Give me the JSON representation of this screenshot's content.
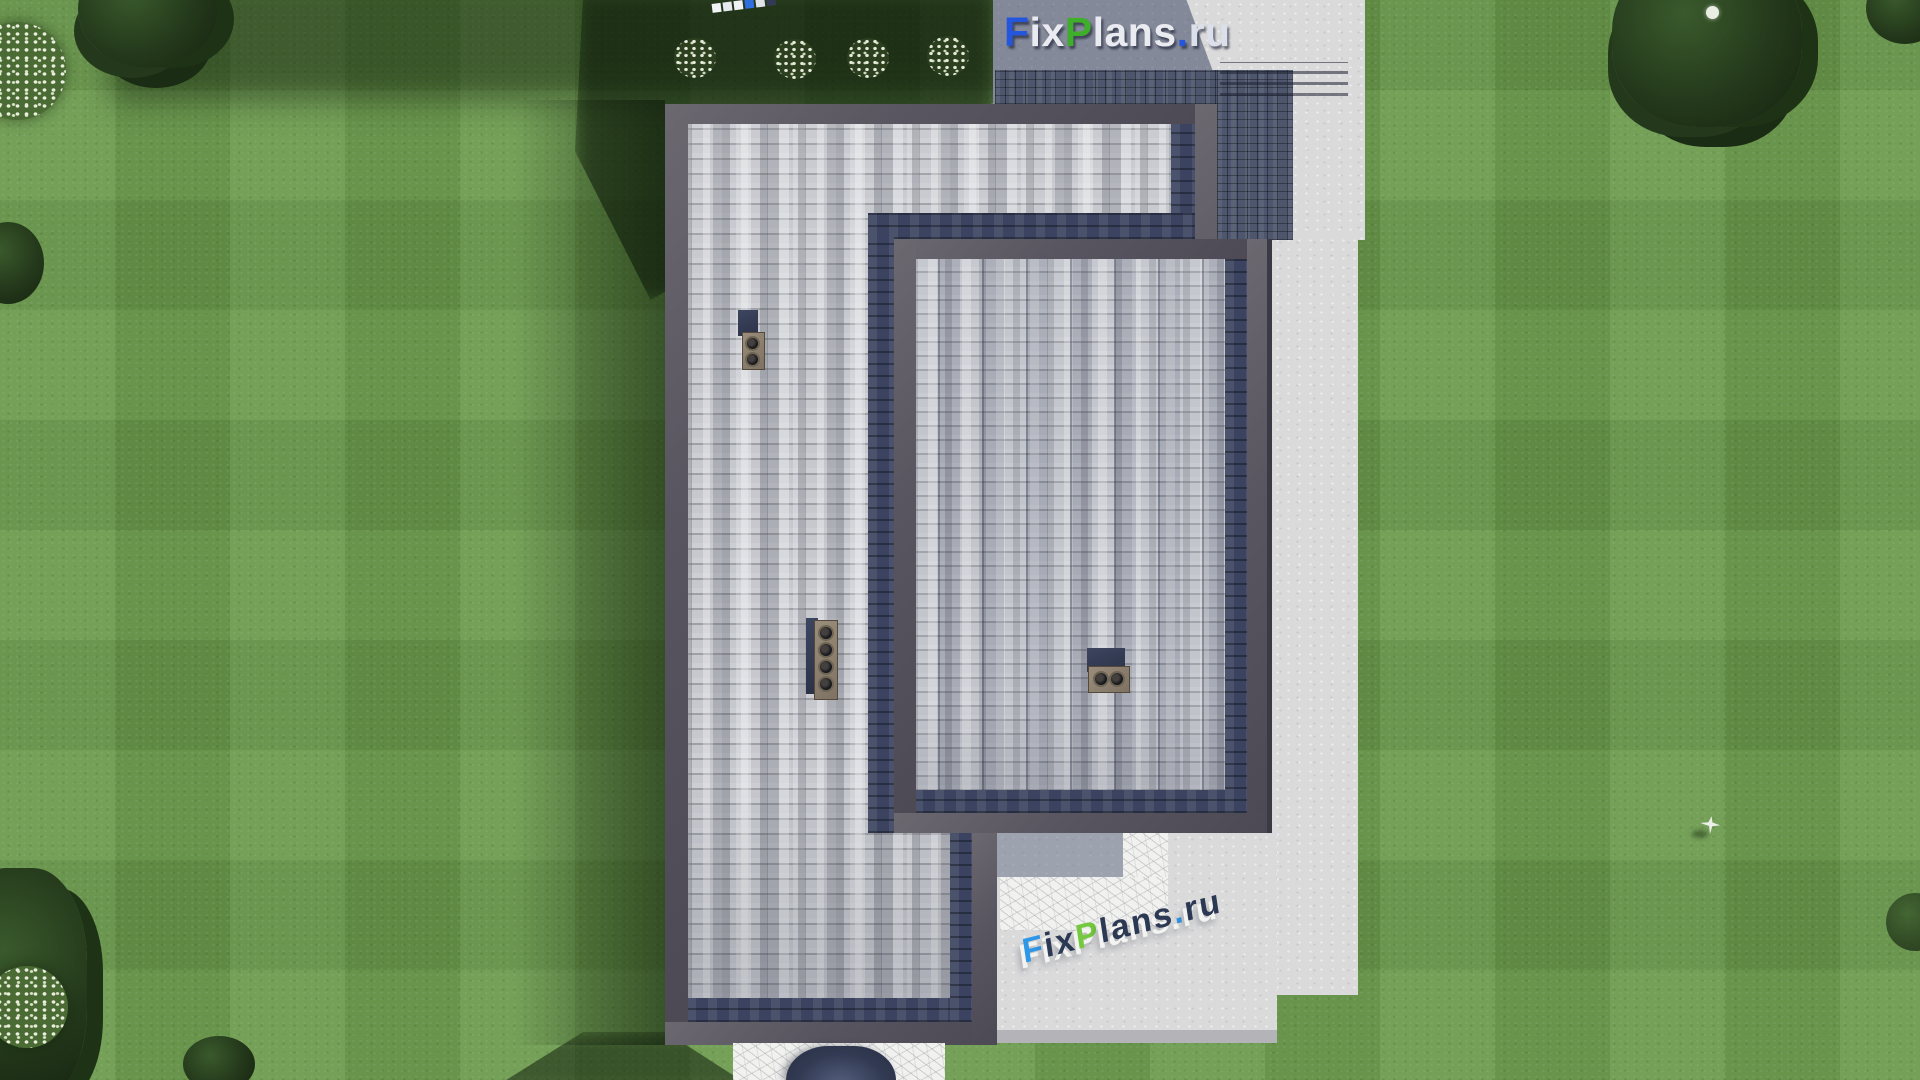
{
  "watermark_top": {
    "text": "FixPlans.ru",
    "segments": [
      {
        "t": "F",
        "color": "#2456dd"
      },
      {
        "t": "ix",
        "color": "#e9ebf0"
      },
      {
        "t": "P",
        "color": "#3fae2a"
      },
      {
        "t": "lans",
        "color": "#e9ebf0"
      },
      {
        "t": ".",
        "color": "#2456dd"
      },
      {
        "t": "ru",
        "color": "#dce0ea"
      }
    ]
  },
  "watermark_ground": {
    "text": "FixPlans.ru",
    "segments": [
      {
        "t": "F",
        "color": "#2f97e8"
      },
      {
        "t": "ix",
        "color": "#2c3954"
      },
      {
        "t": "P",
        "color": "#74c93e"
      },
      {
        "t": "lans",
        "color": "#2c3954"
      },
      {
        "t": ".",
        "color": "#2f97e8"
      },
      {
        "t": "ru",
        "color": "#2c3954"
      }
    ]
  },
  "palette": {
    "lawn_green": "#69984a",
    "shingle_light_gray": "#c6c8ce",
    "shingle_striped_gray": "#bcbfc7",
    "shingle_shadow_navy": "#3b4360",
    "parapet_gray": "#585560",
    "concrete_light": "#dadadb",
    "concrete_shadow_blue": "#5e6a8a",
    "tile_paving_dark": "#4d566d",
    "chimney_cap_tan": "#8d8070",
    "canopy_navy": "#333b54"
  },
  "scene": {
    "view": "top-down aerial render of a flat-roof house",
    "objects": [
      "lawn",
      "main-roof",
      "secondary-roof",
      "chimney-2-flue",
      "chimney-4-flue",
      "chimney-2-flue-horizontal",
      "concrete-walkway",
      "tiled-patio",
      "steps",
      "entrance-canopy",
      "trees",
      "flower-bushes",
      "flying-bird"
    ]
  }
}
